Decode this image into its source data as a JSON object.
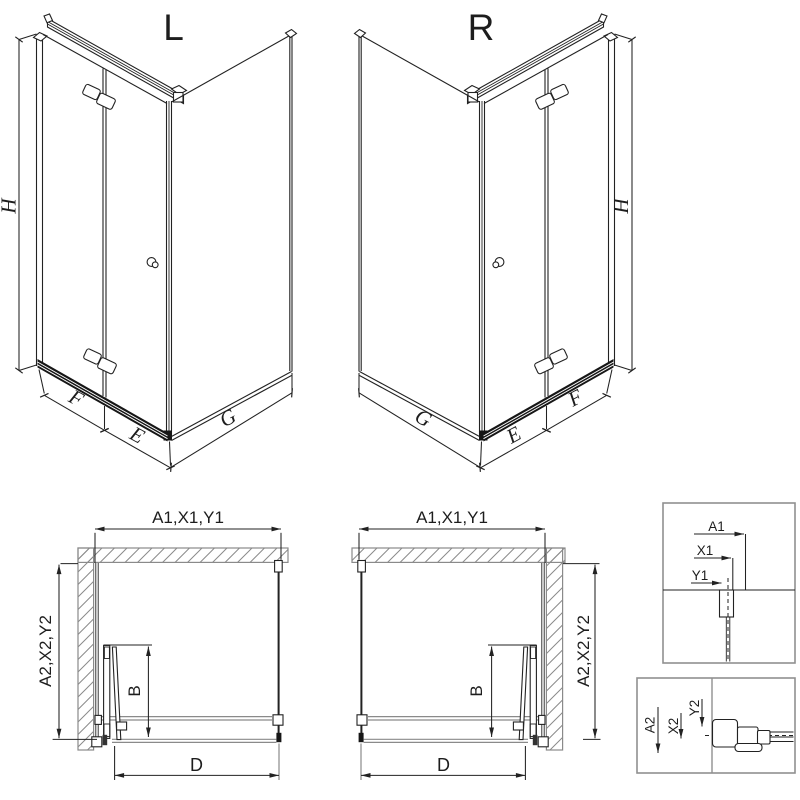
{
  "iso_left": {
    "title": "L",
    "dim_height": "H",
    "dim_door_panel": "F",
    "dim_door": "E",
    "dim_side_panel": "G"
  },
  "iso_right": {
    "title": "R",
    "dim_height": "H",
    "dim_door_panel": "F",
    "dim_door": "E",
    "dim_side_panel": "G"
  },
  "plan_left": {
    "dim_width": "A1,X1,Y1",
    "dim_depth": "A2,X2,Y2",
    "dim_fold": "B",
    "dim_entry": "D"
  },
  "plan_right": {
    "dim_width": "A1,X1,Y1",
    "dim_depth": "A2,X2,Y2",
    "dim_fold": "B",
    "dim_entry": "D"
  },
  "detail_top": {
    "dim_a1": "A1",
    "dim_x1": "X1",
    "dim_y1": "Y1"
  },
  "detail_bottom": {
    "dim_a2": "A2",
    "dim_x2": "X2",
    "dim_y2": "Y2"
  },
  "colors": {
    "line": "#222222",
    "wall_hatch": "#8a8a8a",
    "rail_dark": "#161616",
    "box_border": "#909090",
    "background": "#ffffff"
  }
}
